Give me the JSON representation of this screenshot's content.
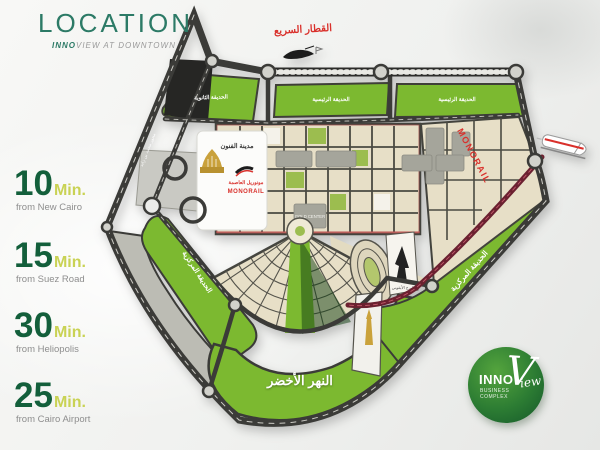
{
  "header": {
    "title": "LOCATION",
    "brand_bold": "INNO",
    "brand_rest": "VIEW AT DOWNTOWN"
  },
  "travel_times": [
    {
      "value": "10",
      "unit": "Min.",
      "origin": "from New Cairo"
    },
    {
      "value": "15",
      "unit": "Min.",
      "origin": "from Suez Road"
    },
    {
      "value": "30",
      "unit": "Min.",
      "origin": "from Heliopolis"
    },
    {
      "value": "25",
      "unit": "Min.",
      "origin": "from Cairo Airport"
    }
  ],
  "map": {
    "high_speed_rail": "القطار السريع",
    "monorail_side": "MONORAIL",
    "park_block_1": "الحديقة الثانوية",
    "park_block_2": "الحديقة الرئيسية",
    "park_block_3": "الحديقة الرئيسية",
    "city_of_arts": "مدينة الفنون",
    "station_ar": "مونوريل العاصمة",
    "station_en": "MONORAIL",
    "gold_center": "GOLD CENTER",
    "iconic_tower": "البرج الأيقوني",
    "green_river": "النهر الأخضر",
    "central_park_left": "الحديقة المركزية",
    "central_park_right": "الحديقة المركزية",
    "road_name": "محور محمد بن زايد"
  },
  "logo": {
    "top": "INNO",
    "script_initial": "V",
    "script_rest": "iew",
    "bottom": "BUSINESS COMPLEX"
  },
  "colors": {
    "brand_green": "#2c7a66",
    "number_green": "#135f3b",
    "min_yellow_green": "#c9d254",
    "muted_gray": "#8e8e8e",
    "map_green": "#7cb930",
    "road_dark": "#3b3b38",
    "red_accent": "#d9302b",
    "monorail_maroon": "#6b2130",
    "parcel_beige": "#e7dfc7",
    "logo_green": "#2c7c33"
  }
}
